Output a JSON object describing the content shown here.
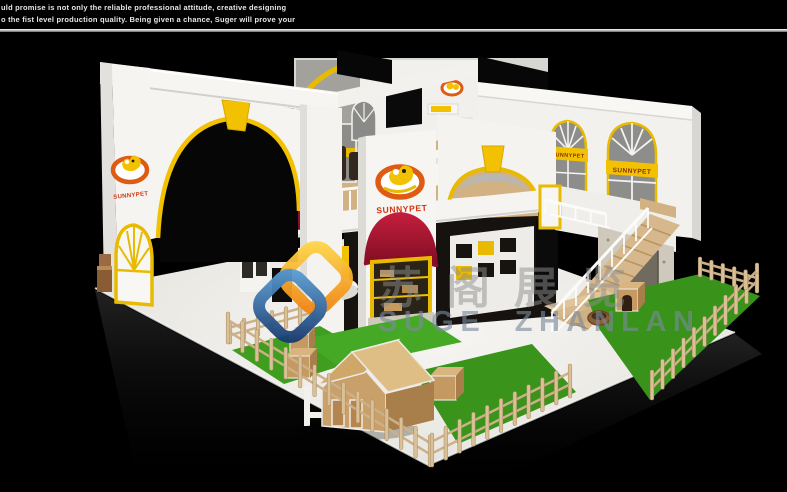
{
  "header": {
    "line1": "uld promise is not only the reliable professional attitude, creative designing",
    "line2": "o the fist level production quality. Being given a chance, Suger will prove your"
  },
  "booth": {
    "brand": "SUNNYPET",
    "signs": {
      "left_pillar": "SUNNYPET",
      "center_pillar": "SUNNYPET",
      "window_banner_left": "SUNNYPET",
      "window_banner_right": "SUNNYPET"
    }
  },
  "watermark": {
    "cn": "苏阁展览",
    "en": "SUGE ZHANLAN"
  },
  "colors": {
    "background": "#000000",
    "wall_white": "#f5f4f1",
    "accent_yellow": "#f2c101",
    "awning_red": "#a41430",
    "brand_red": "#d43310",
    "wood": "#d5b488",
    "grass_green": "#3f9e1f",
    "stone_gray": "#cfc9bd",
    "window_gray": "#8d8d8b",
    "watermark_blue": "#2d5ca6",
    "watermark_orange": "#f6a21c",
    "watermark_text": "#7b8a9d"
  }
}
